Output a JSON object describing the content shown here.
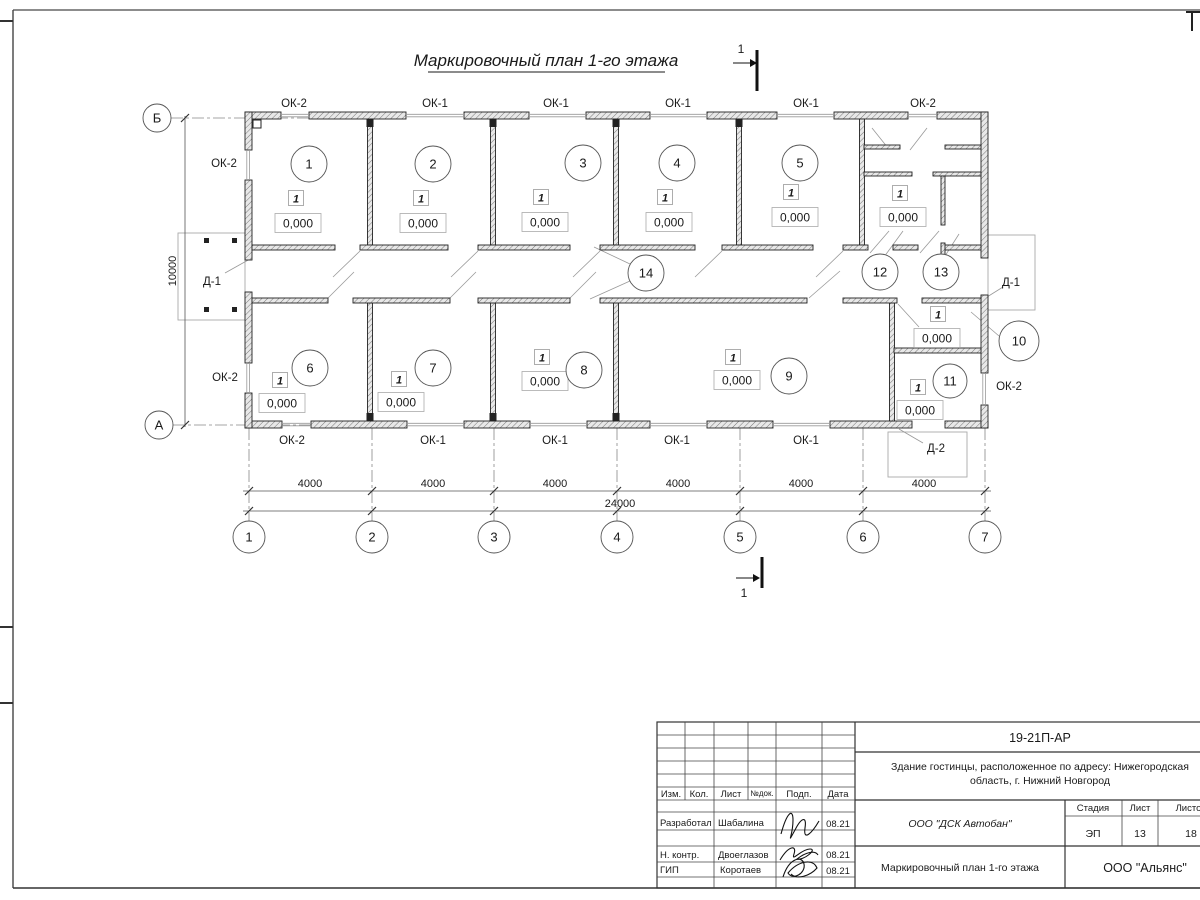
{
  "sheet": {
    "title": "Маркировочный план 1-го этажа",
    "code": "19-21П-АР",
    "object_name_line1": "Здание гостинцы, расположенное по адресу: Нижегородская",
    "object_name_line2": "область, г. Нижний Новгород",
    "drawing_name": "Маркировочный план 1-го этажа",
    "design_org": "ООО \"ДСК Автобан\"",
    "customer_org": "ООО \"Альянс\"",
    "stage_label": "Стадия",
    "stage": "ЭП",
    "sheet_label": "Лист",
    "sheet_no": "13",
    "sheets_label": "Листов",
    "sheets_total": "18",
    "header_cols": {
      "izm": "Изм.",
      "kol": "Кол.",
      "list": "Лист",
      "ndok": "№док.",
      "podp": "Подп.",
      "data": "Дата"
    },
    "roles": {
      "developed": "Разработал",
      "norm": "Н. контр.",
      "gip": "ГИП"
    },
    "names": {
      "developed": "Шабалина",
      "norm": "Двоеглазов",
      "gip": "Коротаев"
    },
    "date": "08.21"
  },
  "plan": {
    "rooms": [
      "1",
      "2",
      "3",
      "4",
      "5",
      "6",
      "7",
      "8",
      "9",
      "10",
      "11",
      "12",
      "13",
      "14"
    ],
    "axes_h": [
      "1",
      "2",
      "3",
      "4",
      "5",
      "6",
      "7"
    ],
    "axes_v": {
      "top": "Б",
      "bottom": "А"
    },
    "window_ok1": "ОК-1",
    "window_ok2": "ОК-2",
    "door_d1": "Д-1",
    "door_d2": "Д-2",
    "level": "0,000",
    "floor_no": "1",
    "dim_bay": "4000",
    "dim_total": "24000",
    "dim_depth": "10000",
    "section_no": "1"
  }
}
